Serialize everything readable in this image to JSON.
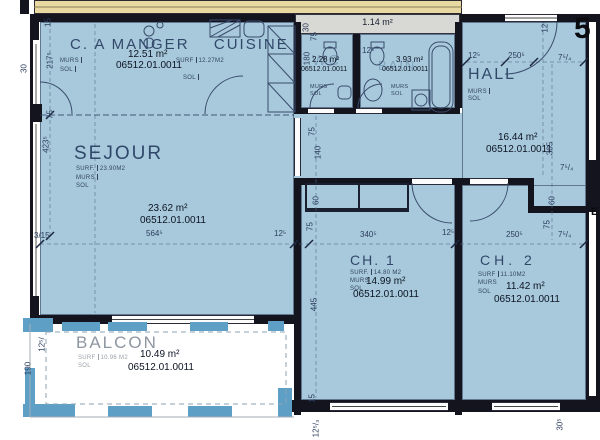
{
  "sheet": {
    "number": "5",
    "edge_letter": "E"
  },
  "unit_id": "06512.01.0011",
  "rooms": {
    "dining": {
      "title": "C. A MANGER",
      "title2": "CUISINE",
      "area": "12.51 m²",
      "id": "06512.01.0011",
      "surf_label": "SURF",
      "surf_value": "12.27M2",
      "murs": "MURS",
      "sol": "SOL",
      "sol2": "SOL"
    },
    "wc": {
      "ghost": "WC",
      "area": "2.28 m²",
      "id": "06512.01.0011",
      "murs": "MURS",
      "sol": "SOL"
    },
    "bain": {
      "ghost": "BAIN",
      "area": "3.93 m²",
      "id": "06512.01.0011",
      "murs": "MURS",
      "sol": "SOL"
    },
    "shaft": {
      "area": "1.14 m²"
    },
    "hall": {
      "title": "HALL",
      "area": "16.44 m²",
      "id": "06512.01.0011",
      "murs": "MURS",
      "sol": "SOL"
    },
    "sejour": {
      "title": "SEJOUR",
      "surf_label": "SURF.",
      "surf_value": "23.90M2",
      "murs": "MURS",
      "sol": "SOL",
      "area": "23.62 m²",
      "id": "06512.01.0011"
    },
    "ch1": {
      "title": "CH. 1",
      "surf_label": "SURF.",
      "surf_value": "14.80 M2",
      "murs": "MURS",
      "sol": "SOL",
      "area": "14.99 m²",
      "id": "06512.01.0011"
    },
    "ch2": {
      "title": "CH. 2",
      "surf_label": "SURF",
      "surf_value": "11.10M2",
      "murs": "MURS",
      "sol": "SOL",
      "area": "11.42 m²",
      "id": "06512.01.0011"
    },
    "balcon": {
      "title": "BALCON",
      "surf_label": "SURF",
      "surf_value": "10.96 M2",
      "sol": "SOL",
      "area": "10.49 m²",
      "id": "06512.01.0011"
    }
  },
  "dims": [
    "15",
    "217⁵",
    "30",
    "75",
    "423⁵",
    "3/15",
    "564⁵",
    "12⁵",
    "340⁵",
    "12⁵",
    "250⁵",
    "7⁵/₄",
    "12⁵",
    "250⁵",
    "7⁵/₄",
    "12⁵",
    "365",
    "75",
    "140",
    "60",
    "75",
    "445",
    "75",
    "180",
    "12⁵",
    "30",
    "60",
    "75",
    "7⁵/₄",
    "190",
    "12⁵/",
    "12⁵/₃",
    "15",
    "30⁵"
  ],
  "colors": {
    "room_fill": "#a7c9db",
    "rail_blue": "#5e9fc5",
    "wall": "#14141f",
    "slab_band": "#e8d9a2",
    "shaft_gray": "#d8d8d4",
    "label_ink": "#2c3c5e"
  }
}
